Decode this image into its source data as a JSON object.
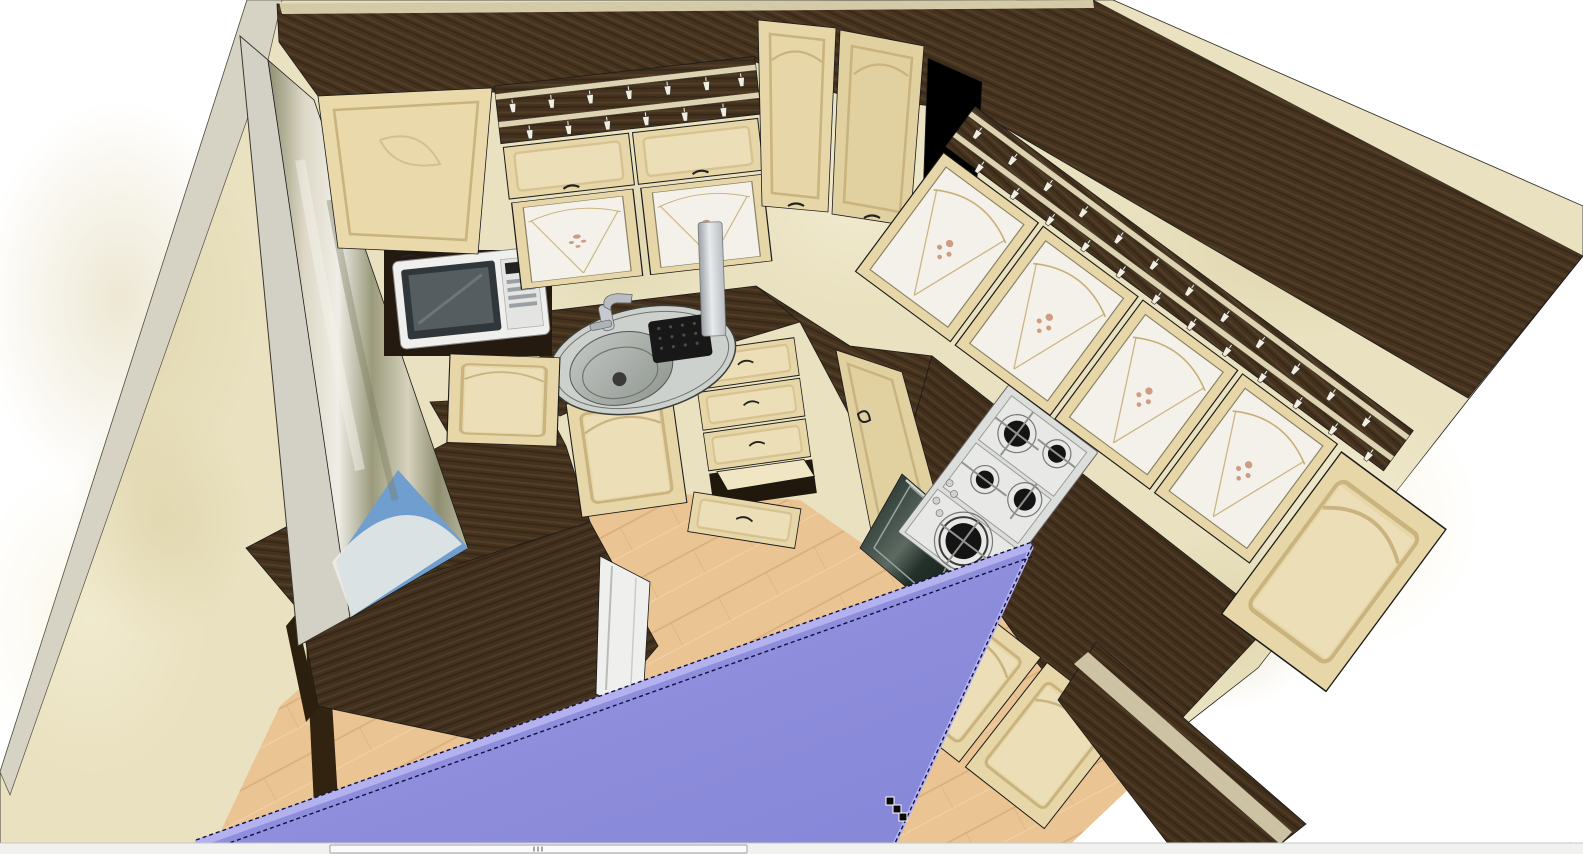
{
  "window": {
    "kind": "3d-kitchen-designer-viewport"
  },
  "colors": {
    "background": "#ffffff",
    "wall": "#e9e1bf",
    "wall_shade": "#dcd2ab",
    "wall_edge": "#d6d2c4",
    "wenge_dark": "#44311e",
    "wenge_mid": "#55402a",
    "wenge_streak": "#2f2112",
    "cabinet": "#e7d7a8",
    "cabinet_light": "#f1e6c4",
    "cabinet_bead": "#c9b37f",
    "glass_white": "#f3f1ea",
    "glass_line": "#c2a86a",
    "decal_rose": "#c4886a",
    "rail_cream": "#ddd3b2",
    "floor": "#eac493",
    "floor_line": "#c89a64",
    "steel": "#dcdedb",
    "burner_black": "#141414",
    "oven_dark": "#232a26",
    "oven_sheen": "#5c6a62",
    "sink_rim": "#ccd1cd",
    "sink_bowl": "#a9b0ab",
    "curtain_olive": "#8f8f72",
    "curtain_cream": "#ddd8c6",
    "curtain_white": "#efede6",
    "sky_blue": "#6f9ecf",
    "white_goods": "#eff0ee",
    "selection_purple": "#8c8cdb",
    "selection_light": "#b3b2ef",
    "selection_dash": "#101040",
    "scroll_track": "#f1f1ef",
    "scroll_thumb": "#fbfbfb",
    "scroll_border": "#a0a0a0",
    "scroll_grip": "#8c8c8c",
    "cursor_black": "#0a0a0a"
  },
  "scene": {
    "objects": [
      "room-walls",
      "window-with-curtain",
      "wall-cabinet-run-left",
      "wall-cabinet-run-right",
      "corner-wall-cabinets",
      "tall-wall-cabinet-door",
      "stemware-rails",
      "hood-chimney",
      "microwave",
      "sink",
      "faucet",
      "drain-grid",
      "worktop",
      "base-door-left",
      "base-drawer-unit",
      "open-drawer",
      "base-door-corner",
      "gas-hob",
      "oven",
      "base-doors-right",
      "dining-table",
      "white-appliance",
      "floor-laminate",
      "ceiling-panel-selected"
    ],
    "selected_object": "ceiling-panel",
    "selection_color": "#8c8cdb"
  },
  "cursor": {
    "style": "snap-handles",
    "squares": [
      {
        "x": 886,
        "y": 797
      },
      {
        "x": 893,
        "y": 805
      },
      {
        "x": 899,
        "y": 813
      }
    ]
  },
  "pointer": {
    "x": 1570,
    "y": 842
  },
  "scrollbar": {
    "orientation": "horizontal",
    "track": {
      "x": 0,
      "y": 843,
      "width": 1583,
      "height": 11
    },
    "thumb": {
      "x": 330,
      "width": 417
    },
    "grip_marks": 3
  }
}
